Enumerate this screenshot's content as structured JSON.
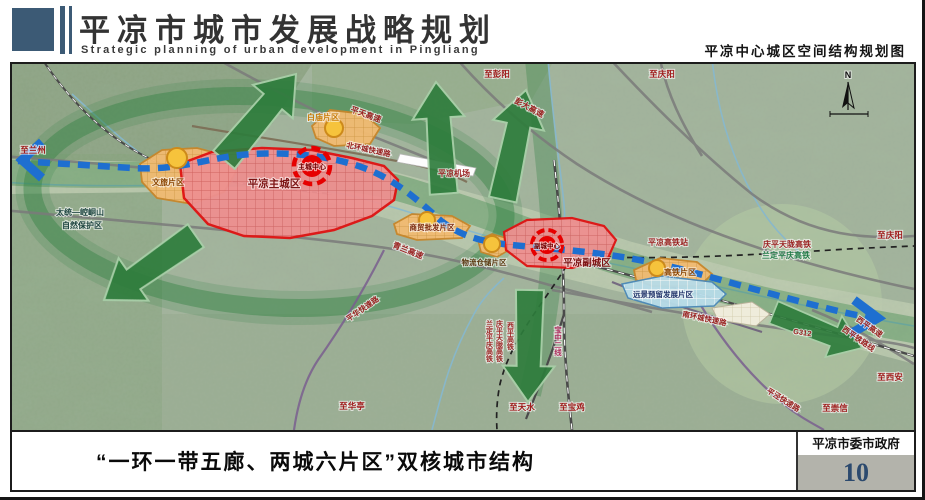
{
  "header": {
    "title": "平凉市城市发展战略规划",
    "subtitle": "Strategic planning of urban development in Pingliang",
    "sheet_title": "平凉中心城区空间结构规划图"
  },
  "footer": {
    "caption": "“一环一带五廊、两城六片区”双核城市结构",
    "agency": "平凉市委市政府",
    "page_number": "10"
  },
  "colors": {
    "header_accent": "#3c5a75",
    "page_number_blue": "#2c4a6e",
    "gov_box_gray": "#b3b3ab",
    "corridor_green": "#2e7d3c",
    "transit_blue": "#1e6fd0",
    "city_red": "#e01212",
    "district_orange": "#f2bb72",
    "reserve_blue": "#b7dce9",
    "road_label_red": "#9a1f1f"
  },
  "map": {
    "compass": "N",
    "labels": [
      {
        "n": "label-to-lanzhou",
        "t": "至兰州",
        "x": 21,
        "y": 89,
        "s": 8.5,
        "c": "#a01c1c"
      },
      {
        "n": "label-nature-reserve-1",
        "t": "太统—崆峒山",
        "x": 68,
        "y": 151,
        "s": 8,
        "c": "#1d4440"
      },
      {
        "n": "label-nature-reserve-2",
        "t": "自然保护区",
        "x": 70,
        "y": 164,
        "s": 8,
        "c": "#1d4440"
      },
      {
        "n": "label-to-pengyang",
        "t": "至彭阳",
        "x": 485,
        "y": 13,
        "s": 8.5,
        "c": "#a01c1c"
      },
      {
        "n": "label-to-qingyang-top",
        "t": "至庆阳",
        "x": 650,
        "y": 13,
        "s": 8.5,
        "c": "#a01c1c"
      },
      {
        "n": "label-pingtian-expwy",
        "t": "平天高速",
        "x": 353,
        "y": 53,
        "s": 8,
        "c": "#9a1f1f",
        "r": 20
      },
      {
        "n": "label-pengda-expwy",
        "t": "彭大高速",
        "x": 516,
        "y": 46,
        "s": 8,
        "c": "#9a1f1f",
        "r": 28
      },
      {
        "n": "label-north-ring-road",
        "t": "北环城快速路",
        "x": 356,
        "y": 88,
        "s": 7.5,
        "c": "#9a1f1f",
        "r": 12
      },
      {
        "n": "label-baimiao-district",
        "t": "白庙片区",
        "x": 311,
        "y": 56,
        "s": 8,
        "c": "#c97c08"
      },
      {
        "n": "label-airport",
        "t": "平凉机场",
        "x": 442,
        "y": 112,
        "s": 8,
        "c": "#9a1f1f"
      },
      {
        "n": "label-main-city",
        "t": "平凉主城区",
        "x": 262,
        "y": 123,
        "s": 10.5,
        "c": "#7c1414"
      },
      {
        "n": "label-main-center",
        "t": "主城中心",
        "x": 300,
        "y": 105,
        "s": 7,
        "c": "#6b0000"
      },
      {
        "n": "label-wenlv-district",
        "t": "文旅片区",
        "x": 156,
        "y": 121,
        "s": 8,
        "c": "#8a4400"
      },
      {
        "n": "label-qinglan-expwy",
        "t": "青兰高速",
        "x": 395,
        "y": 189,
        "s": 8,
        "c": "#9a1f1f",
        "r": 22
      },
      {
        "n": "label-trade-district",
        "t": "商贸批发片区",
        "x": 420,
        "y": 166,
        "s": 7.5,
        "c": "#7c2a10"
      },
      {
        "n": "label-logistics-district",
        "t": "物流仓储片区",
        "x": 472,
        "y": 201,
        "s": 7.5,
        "c": "#5c3a12"
      },
      {
        "n": "label-sub-center",
        "t": "副城中心",
        "x": 535,
        "y": 184,
        "s": 6.5,
        "c": "#6b0000"
      },
      {
        "n": "label-sub-city",
        "t": "平凉副城区",
        "x": 575,
        "y": 202,
        "s": 9.5,
        "c": "#7c1414"
      },
      {
        "n": "label-hsr-station",
        "t": "平凉高铁站",
        "x": 656,
        "y": 181,
        "s": 8,
        "c": "#9a1f1f"
      },
      {
        "n": "label-hsr-qptl",
        "t": "庆平天陇高铁",
        "x": 775,
        "y": 183,
        "s": 8,
        "c": "#9a1f1f"
      },
      {
        "n": "label-hsr-ldpq",
        "t": "兰定平庆高铁",
        "x": 774,
        "y": 194,
        "s": 8,
        "c": "#1f7a46"
      },
      {
        "n": "label-to-qingyang-right",
        "t": "至庆阳",
        "x": 878,
        "y": 174,
        "s": 8.5,
        "c": "#a01c1c"
      },
      {
        "n": "label-gaotie-district",
        "t": "高铁片区",
        "x": 668,
        "y": 211,
        "s": 8,
        "c": "#8a4400"
      },
      {
        "n": "label-reserve-district",
        "t": "远景预留发展片区",
        "x": 651,
        "y": 233,
        "s": 7.5,
        "c": "#23356b"
      },
      {
        "n": "label-south-ring-road",
        "t": "南环城快速路",
        "x": 692,
        "y": 257,
        "s": 7.5,
        "c": "#9a1f1f",
        "r": 12
      },
      {
        "n": "label-g312",
        "t": "G312",
        "x": 790,
        "y": 271,
        "s": 7.5,
        "c": "#9a1f1f",
        "r": 8
      },
      {
        "n": "label-xiping-expwy",
        "t": "西平高速",
        "x": 856,
        "y": 265,
        "s": 7.5,
        "c": "#9a1f1f",
        "r": 35
      },
      {
        "n": "label-xiping-railway",
        "t": "西平铁路线",
        "x": 845,
        "y": 277,
        "s": 7.5,
        "c": "#9a1f1f",
        "r": 35
      },
      {
        "n": "label-to-xian",
        "t": "至西安",
        "x": 878,
        "y": 316,
        "s": 8.5,
        "c": "#a01c1c"
      },
      {
        "n": "label-pingjing-road",
        "t": "平泾快速路",
        "x": 770,
        "y": 338,
        "s": 7.5,
        "c": "#9a1f1f",
        "r": 32
      },
      {
        "n": "label-to-chongxin",
        "t": "至崇信",
        "x": 823,
        "y": 347,
        "s": 8.5,
        "c": "#a01c1c"
      },
      {
        "n": "label-pinghua-road",
        "t": "平华快速路",
        "x": 352,
        "y": 247,
        "s": 7.5,
        "c": "#9a1f1f",
        "r": -35
      },
      {
        "n": "label-to-huating",
        "t": "至华亭",
        "x": 340,
        "y": 345,
        "s": 8.5,
        "c": "#a01c1c"
      },
      {
        "n": "label-to-tianshui",
        "t": "至天水",
        "x": 510,
        "y": 346,
        "s": 8.5,
        "c": "#a01c1c"
      },
      {
        "n": "label-to-baoji",
        "t": "至宝鸡",
        "x": 560,
        "y": 346,
        "s": 8.5,
        "c": "#a01c1c"
      },
      {
        "n": "label-baozhong-line2",
        "t": "宝中二线",
        "x": 546,
        "y": 262,
        "s": 7.5,
        "c": "#b03060",
        "v": 1
      },
      {
        "n": "label-hsr-ldpq-vert",
        "t": "兰定平庆高铁",
        "x": 477,
        "y": 256,
        "s": 7,
        "c": "#9a1f1f",
        "v": 1
      },
      {
        "n": "label-hsr-qptl-vert",
        "t": "庆平天陇高铁",
        "x": 487,
        "y": 256,
        "s": 7,
        "c": "#9a1f1f",
        "v": 1
      },
      {
        "n": "label-xiping-hsr-vert",
        "t": "西平高铁",
        "x": 498,
        "y": 258,
        "s": 7,
        "c": "#9a1f1f",
        "v": 1
      },
      {
        "n": "compass-n-label",
        "t": "N",
        "x": 836,
        "y": 14,
        "s": 9,
        "c": "#111111"
      }
    ]
  }
}
